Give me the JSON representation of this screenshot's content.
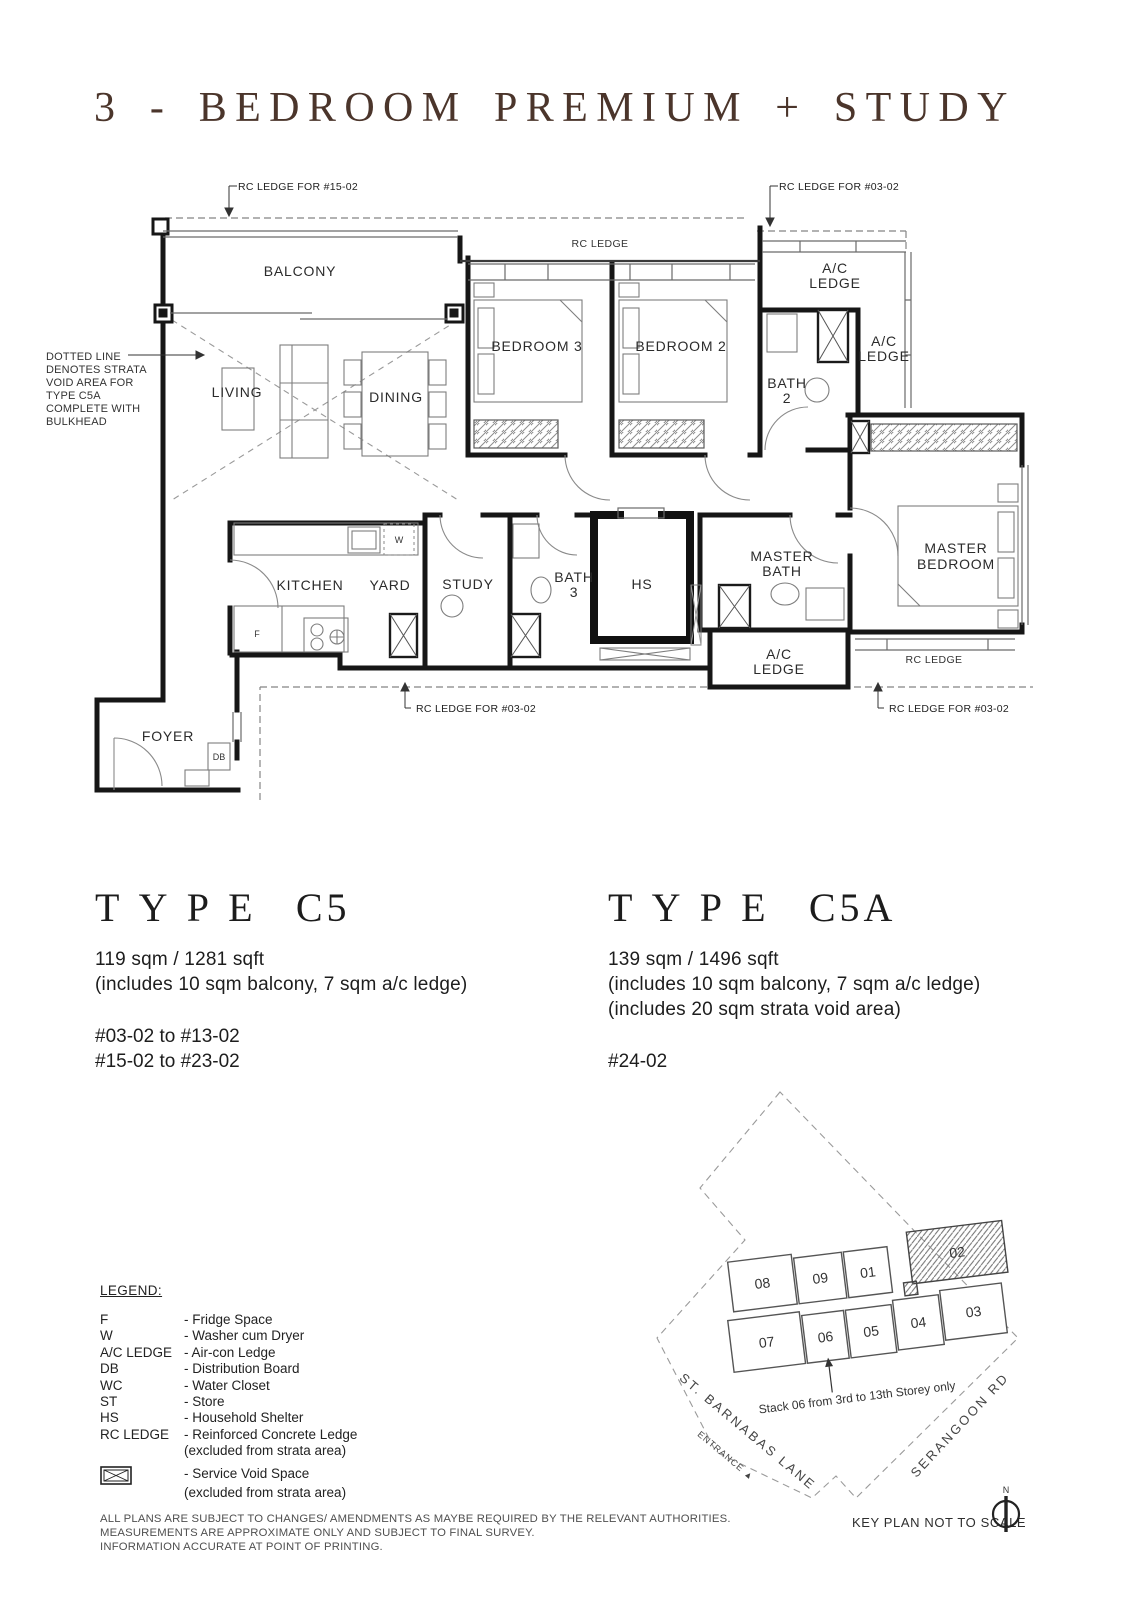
{
  "title": "3 - BEDROOM PREMIUM + STUDY",
  "plan": {
    "callouts": {
      "top_left": "RC LEDGE FOR #15-02",
      "top_right": "RC LEDGE FOR #03-02",
      "bottom_left": "RC LEDGE FOR #03-02",
      "bottom_right": "RC LEDGE FOR #03-02",
      "rc_ledge_top": "RC LEDGE",
      "rc_ledge_master": "RC LEDGE"
    },
    "strata_note_lines": [
      "DOTTED LINE",
      "DENOTES STRATA",
      "VOID AREA FOR",
      "TYPE C5A",
      "COMPLETE WITH",
      "BULKHEAD"
    ],
    "rooms": {
      "balcony": "BALCONY",
      "living": "LIVING",
      "dining": "DINING",
      "bedroom3": "BEDROOM 3",
      "bedroom2": "BEDROOM 2",
      "bath2_l1": "BATH",
      "bath2_l2": "2",
      "ac_ledge_l1": "A/C",
      "ac_ledge_l2": "LEDGE",
      "kitchen": "KITCHEN",
      "yard": "YARD",
      "study": "STUDY",
      "bath3_l1": "BATH",
      "bath3_l2": "3",
      "hs": "HS",
      "master_bath_l1": "MASTER",
      "master_bath_l2": "BATH",
      "master_bedroom_l1": "MASTER",
      "master_bedroom_l2": "BEDROOM",
      "foyer": "FOYER"
    },
    "markers": {
      "fridge": "F",
      "washer": "W",
      "db": "DB"
    }
  },
  "types": {
    "c5": {
      "label": "TYPE",
      "code": "C5",
      "area": "119 sqm / 1281 sqft",
      "note1": "(includes 10 sqm balcony, 7 sqm a/c ledge)",
      "units": [
        "#03-02 to #13-02",
        "#15-02 to #23-02"
      ]
    },
    "c5a": {
      "label": "TYPE",
      "code": "C5A",
      "area": "139 sqm / 1496 sqft",
      "note1": "(includes 10 sqm balcony, 7 sqm a/c ledge)",
      "note2": "(includes 20 sqm strata void area)",
      "units": [
        "#24-02"
      ]
    }
  },
  "legend": {
    "heading": "LEGEND:",
    "items": [
      {
        "key": "F",
        "desc": "- Fridge Space"
      },
      {
        "key": "W",
        "desc": "- Washer cum Dryer"
      },
      {
        "key": "A/C LEDGE",
        "desc": "- Air-con Ledge"
      },
      {
        "key": "DB",
        "desc": "- Distribution Board"
      },
      {
        "key": "WC",
        "desc": "- Water Closet"
      },
      {
        "key": "ST",
        "desc": "- Store"
      },
      {
        "key": "HS",
        "desc": "- Household Shelter"
      },
      {
        "key": "RC LEDGE",
        "desc": "- Reinforced Concrete Ledge",
        "desc2": "(excluded from strata area)"
      }
    ],
    "service_void": {
      "desc": "- Service Void Space",
      "desc2": "(excluded from strata area)"
    }
  },
  "keyplan": {
    "stacks_row1": [
      "08",
      "09",
      "01",
      "02"
    ],
    "stacks_row2": [
      "07",
      "06",
      "05",
      "04",
      "03"
    ],
    "highlighted_stack": "02",
    "note": "Stack 06 from 3rd to 13th Storey only",
    "street_left": "ST. BARNABAS LANE",
    "entrance_label": "ENTRANCE ▲",
    "street_right": "SERANGOON RD",
    "caption": "KEY PLAN NOT TO SCALE",
    "north_label": "N"
  },
  "disclaimer_lines": [
    "ALL PLANS ARE SUBJECT TO CHANGES/ AMENDMENTS AS MAYBE REQUIRED BY THE RELEVANT AUTHORITIES.",
    "MEASUREMENTS ARE APPROXIMATE ONLY AND SUBJECT TO FINAL SURVEY.",
    "INFORMATION ACCURATE AT POINT OF PRINTING."
  ],
  "colors": {
    "title_brown": "#4b352b",
    "ink": "#1c1c1c",
    "line_gray": "#8a8a8a"
  }
}
